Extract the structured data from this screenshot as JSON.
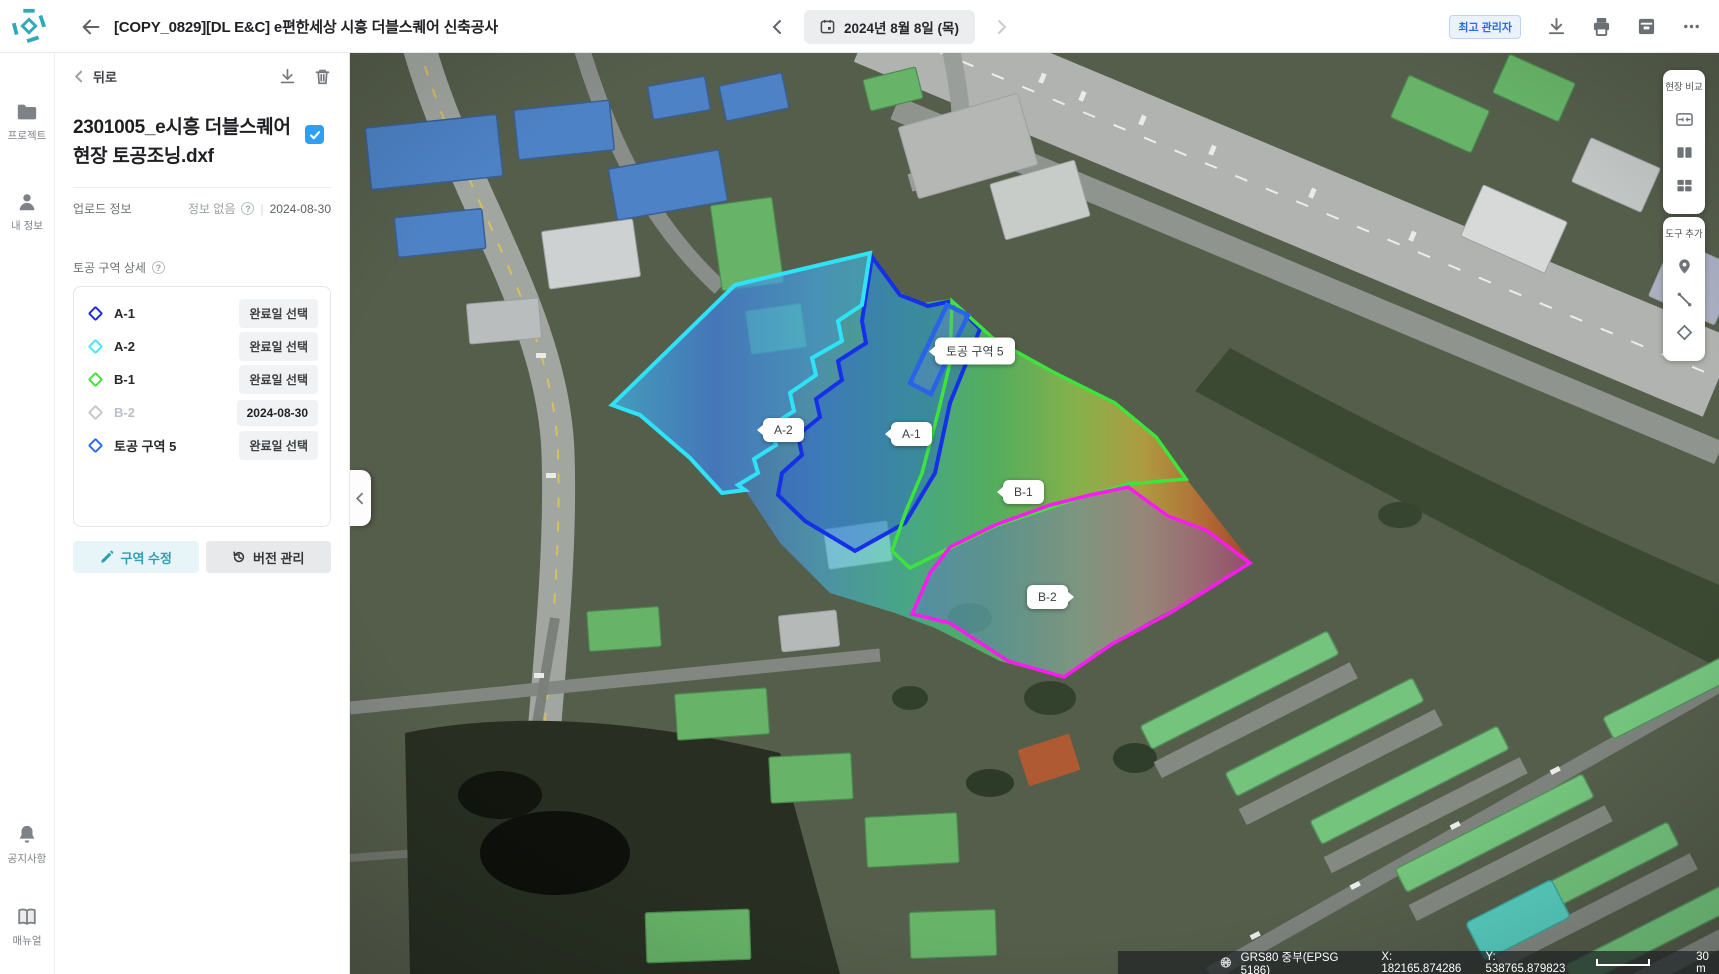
{
  "header": {
    "title": "[COPY_0829][DL E&C] e편한세상 시흥 더블스퀘어 신축공사",
    "date_label": "2024년 8월 8일 (목)",
    "role_badge": "최고 관리자"
  },
  "sidebar": {
    "items": [
      {
        "label": "프로젝트",
        "icon": "folder-icon"
      },
      {
        "label": "내 정보",
        "icon": "person-icon"
      }
    ],
    "bottom_items": [
      {
        "label": "공지사항",
        "icon": "bell-icon"
      },
      {
        "label": "매뉴얼",
        "icon": "book-icon"
      }
    ]
  },
  "panel": {
    "back_label": "뒤로",
    "file_name": "2301005_e시흥 더블스퀘어 현장 토공조닝.dxf",
    "upload_label": "업로드 정보",
    "upload_value": "정보 없음",
    "upload_date": "2024-08-30",
    "section_title": "토공 구역 상세",
    "zones": [
      {
        "name": "A-1",
        "color": "#1b2fd8",
        "action": "완료일 선택",
        "disabled": false
      },
      {
        "name": "A-2",
        "color": "#42e8f5",
        "action": "완료일 선택",
        "disabled": false
      },
      {
        "name": "B-1",
        "color": "#43e23e",
        "action": "완료일 선택",
        "disabled": false
      },
      {
        "name": "B-2",
        "color": "#c4c8cc",
        "action": "2024-08-30",
        "disabled": true
      },
      {
        "name": "토공 구역 5",
        "color": "#2f6cf2",
        "action": "완료일 선택",
        "disabled": false
      }
    ],
    "edit_button": "구역 수정",
    "version_button": "버전 관리"
  },
  "map": {
    "zone_labels": [
      "A-2",
      "A-1",
      "B-1",
      "B-2",
      "토공 구역 5"
    ],
    "compare_panel_title": "현장 비교",
    "tools_panel_title": "도구 추가",
    "overlay_colors": {
      "a1_outline": "#1530e6",
      "a2_outline": "#2fe3f7",
      "b1_outline": "#3ce43c",
      "b2_outline": "#fb1af0",
      "zone5_outline": "#2b63e8",
      "accent": "#2fa8bc"
    },
    "statusbar": {
      "crs": "GRS80 중부(EPSG 5186)",
      "x": "X: 182165.874286",
      "y": "Y: 538765.879823",
      "scale": "30 m"
    }
  }
}
